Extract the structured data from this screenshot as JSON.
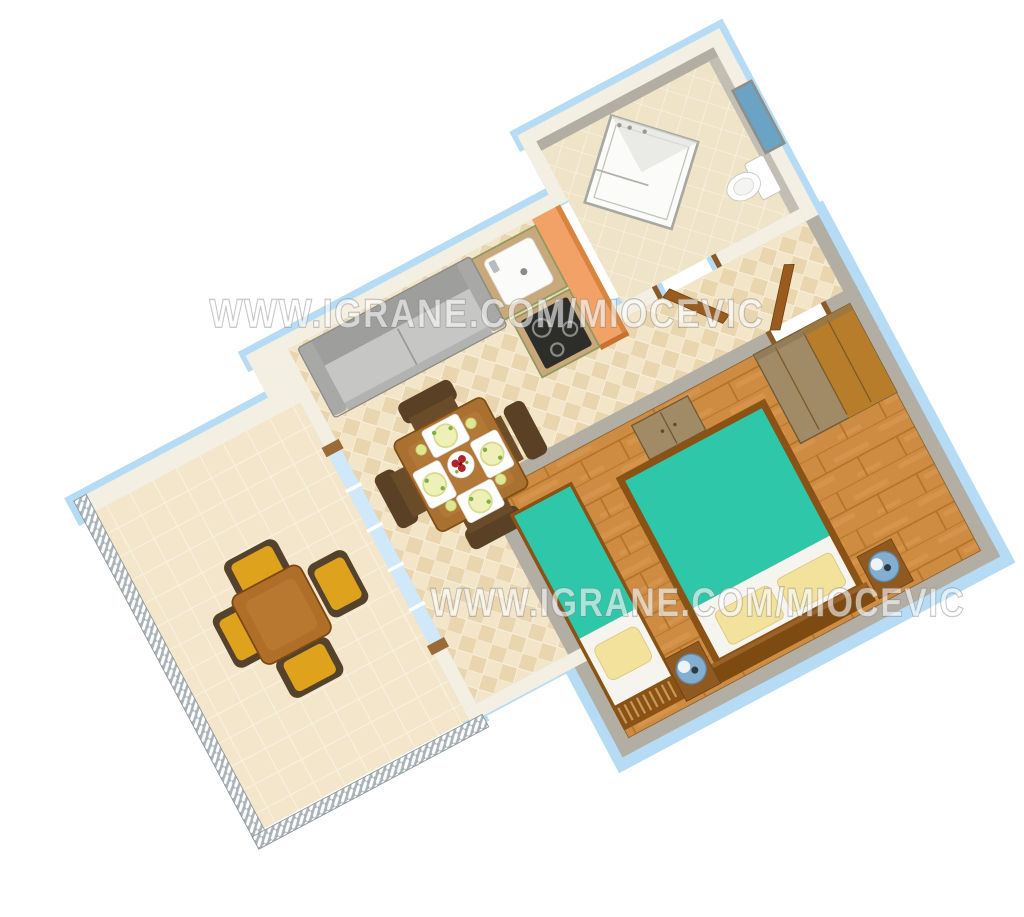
{
  "watermarks": [
    {
      "text": "WWW.IGRANE.COM/MIOCEVIC"
    },
    {
      "text": "WWW.IGRANE.COM/MIOCEVIC"
    }
  ],
  "colors": {
    "wall_blue": "#b5dcf4",
    "wall_cream": "#f3efe2",
    "wall_gray": "#b2aea4",
    "tile_beige": "#f0e1c0",
    "wood_floor": "#cd8c42",
    "bed_teal": "#2ec7aa",
    "pillow_yellow": "#f2e29b",
    "cabinet_orange": "#f2a266",
    "chair_yellow": "#dfa21c",
    "window_blue": "#6aa3c4",
    "sofa_gray": "#c6c6c4",
    "table_wood": "#a97030",
    "door_brown": "#9a5c1e"
  }
}
